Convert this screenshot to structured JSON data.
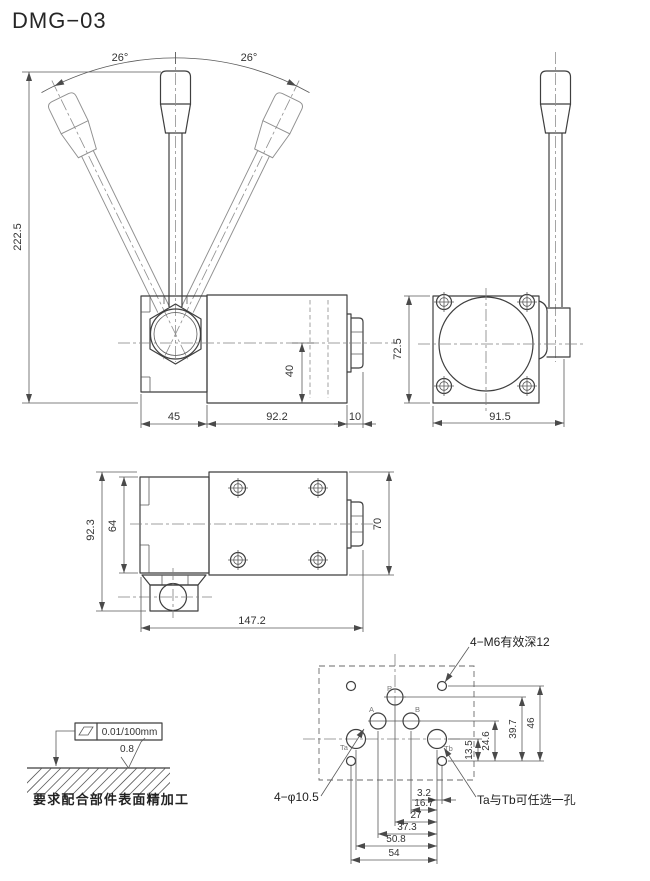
{
  "title": "DMG−03",
  "colors": {
    "line": "#3f3f3f",
    "dim_line": "#5a5a5a",
    "text": "#333333",
    "background": "#ffffff"
  },
  "front_view": {
    "angle_left": "26°",
    "angle_right": "26°",
    "dim_total_height": "222.5",
    "dim_bracket_width": "45",
    "dim_body_length": "92.2",
    "dim_end_plug": "10",
    "dim_port_height": "40"
  },
  "side_view": {
    "dim_height": "72.5",
    "dim_width": "91.5"
  },
  "top_view": {
    "dim_overall_depth": "92.3",
    "dim_bracket_depth": "64",
    "dim_body_width": "70",
    "dim_overall_length": "147.2"
  },
  "surface_note": {
    "flatness_value": "0.01/100mm",
    "roughness_value": "0.8",
    "note_text": "要求配合部件表面精加工"
  },
  "port_layout": {
    "label_m6": "4−M6有效深12",
    "label_holes": "4−φ10.5",
    "label_ta_tb": "Ta与Tb可任选一孔",
    "port_p": "P",
    "port_a": "A",
    "port_b": "B",
    "port_ta": "Ta",
    "port_tb": "Tb",
    "dim_13_5": "13.5",
    "dim_24_6": "24.6",
    "dim_39_7": "39.7",
    "dim_46": "46",
    "dim_3_2": "3.2",
    "dim_16_7": "16.7",
    "dim_27": "27",
    "dim_37_3": "37.3",
    "dim_50_8": "50.8",
    "dim_54": "54"
  }
}
